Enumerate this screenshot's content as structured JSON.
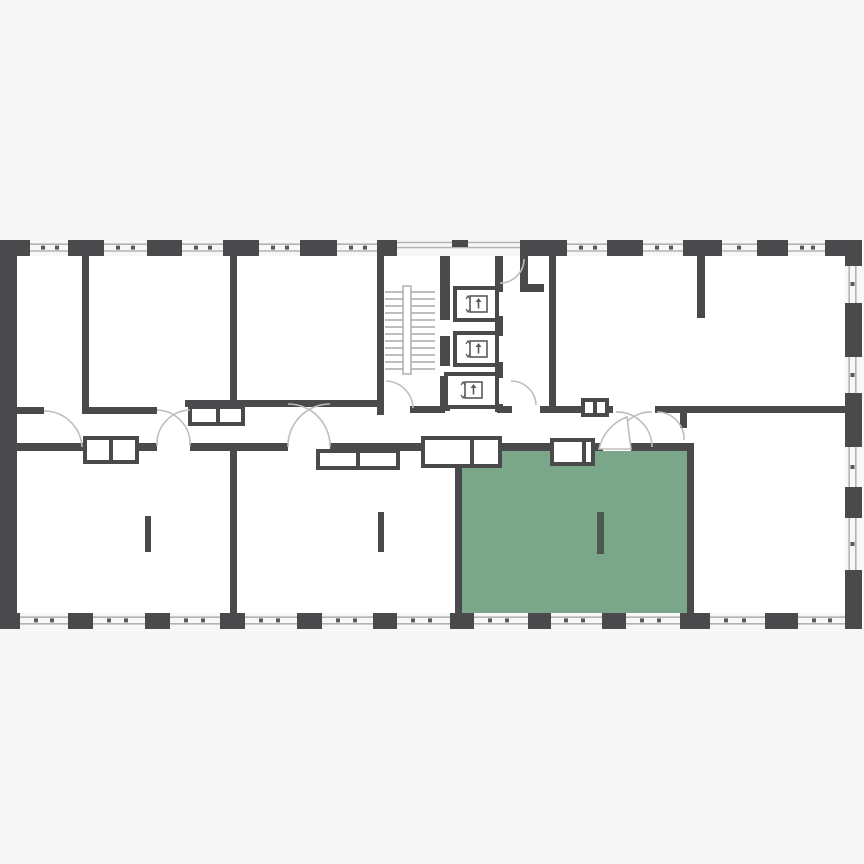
{
  "canvas": {
    "width": 864,
    "height": 864
  },
  "colors": {
    "page_background": "#f7f7f7",
    "floor_background": "#ffffff",
    "wall": "#4a4a4d",
    "highlight": "#7aa689",
    "highlight_column": "#4f584f",
    "window_line": "#b3b3b3",
    "window_dot": "#5a5a5a",
    "door_arc": "#bdbdbd",
    "stair_line": "#a8a8a8",
    "icon": "#5a5a5a",
    "box_fill": "#ffffff"
  },
  "floorplan": {
    "type": "residential-floor-plan",
    "orientation": "landscape-strip",
    "highlighted_unit": "selected-unit",
    "rooms": [
      "room-top-left-1",
      "room-top-left-2",
      "room-top-left-3",
      "stairwell",
      "elevator-lobby",
      "room-top-right",
      "corridor",
      "room-bottom-left-1",
      "room-bottom-left-2",
      "selected-unit",
      "room-bottom-right"
    ],
    "elevators": {
      "count": 3,
      "icon": "elevator-person-up-icon"
    },
    "stairwell": {
      "treads": 12,
      "stringer": "double-rail"
    },
    "column_markers": {
      "count": 3,
      "rooms": [
        "room-bottom-left-1",
        "room-bottom-left-2",
        "selected-unit"
      ]
    },
    "door_swings": {
      "single": 6,
      "double_crossing": 3,
      "filled_leaf": 2
    },
    "window_bands": {
      "top": 9,
      "bottom": 11,
      "right": 4,
      "stair_top_band": 1
    }
  }
}
